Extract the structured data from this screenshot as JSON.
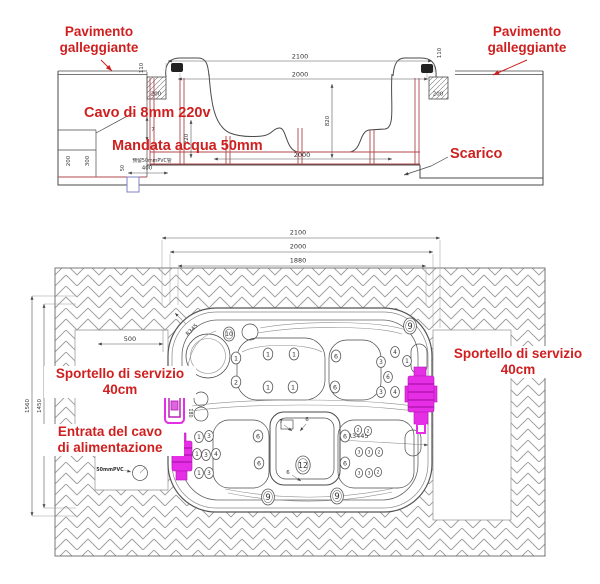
{
  "colors": {
    "red_label": "#cf1f1f",
    "magenta_highlight": "#e62ee6",
    "frame_red": "#b0494c",
    "line": "#4a4a4a",
    "conduit_blue": "#8080c8"
  },
  "section": {
    "labels": {
      "pavimento_left": "Pavimento\ngalleggiante",
      "pavimento_right": "Pavimento\ngalleggiante",
      "cavo": "Cavo di 8mm 220v",
      "mandata": "Mandata acqua 50mm",
      "scarico": "Scarico"
    },
    "dims": {
      "total_width": "2100",
      "rim_width": "2000",
      "depth": "820",
      "side_height": "220",
      "rim_h_left": "110",
      "rim_h_right": "110",
      "block_left": "200",
      "block_right": "200",
      "base_width": "2000",
      "wall_off1": "200",
      "wall_off2": "300",
      "pvc_offset": "400",
      "pvc_small": "50",
      "seven": "7",
      "pvc_note": "预留50mmPVC管"
    }
  },
  "plan": {
    "labels": {
      "sportello_left": "Sportello di servizio\n40cm",
      "sportello_right": "Sportello di servizio\n40cm",
      "entrata": "Entrata del cavo\ndi alimentazione",
      "pvc": "50mmPVC"
    },
    "dims": {
      "w1": "2100",
      "w2": "2000",
      "w3": "1880",
      "h1": "1560",
      "h2": "1450",
      "clear_left": "500",
      "r_corner": "R345",
      "r_body": "R3445",
      "door_note": "180"
    },
    "footwell": {
      "a": "7",
      "b": "6",
      "c": "6"
    },
    "jets": [
      {
        "n": "10",
        "x": 229,
        "y": 334,
        "r": 7,
        "double": true
      },
      {
        "n": "9",
        "x": 410,
        "y": 326,
        "r": 8,
        "double": true
      },
      {
        "n": "9",
        "x": 268,
        "y": 497,
        "r": 8,
        "double": true
      },
      {
        "n": "9",
        "x": 337,
        "y": 496,
        "r": 8,
        "double": true
      },
      {
        "n": "12",
        "x": 303,
        "y": 465,
        "r": 9,
        "double": true
      },
      {
        "n": "1",
        "x": 236,
        "y": 358,
        "r": 6
      },
      {
        "n": "2",
        "x": 236,
        "y": 382,
        "r": 6
      },
      {
        "n": "1",
        "x": 268,
        "y": 354,
        "r": 6
      },
      {
        "n": "1",
        "x": 294,
        "y": 354,
        "r": 6
      },
      {
        "n": "6",
        "x": 336,
        "y": 356,
        "r": 6
      },
      {
        "n": "1",
        "x": 268,
        "y": 387,
        "r": 6
      },
      {
        "n": "1",
        "x": 293,
        "y": 387,
        "r": 6
      },
      {
        "n": "6",
        "x": 335,
        "y": 387,
        "r": 6
      },
      {
        "n": "3",
        "x": 381,
        "y": 362,
        "r": 5.5
      },
      {
        "n": "4",
        "x": 395,
        "y": 352,
        "r": 5.5
      },
      {
        "n": "1",
        "x": 407,
        "y": 361,
        "r": 5.5
      },
      {
        "n": "6",
        "x": 388,
        "y": 377,
        "r": 5.5
      },
      {
        "n": "3",
        "x": 381,
        "y": 392,
        "r": 5.5
      },
      {
        "n": "4",
        "x": 395,
        "y": 392,
        "r": 5.5
      },
      {
        "n": "1",
        "x": 199,
        "y": 437,
        "r": 5.5
      },
      {
        "n": "3",
        "x": 209,
        "y": 436,
        "r": 5.5
      },
      {
        "n": "1",
        "x": 197,
        "y": 454,
        "r": 5.5
      },
      {
        "n": "3",
        "x": 206,
        "y": 455,
        "r": 5.5
      },
      {
        "n": "4",
        "x": 216,
        "y": 454,
        "r": 5.5
      },
      {
        "n": "1",
        "x": 199,
        "y": 473,
        "r": 5.5
      },
      {
        "n": "3",
        "x": 209,
        "y": 473,
        "r": 5.5
      },
      {
        "n": "6",
        "x": 258,
        "y": 436,
        "r": 6
      },
      {
        "n": "6",
        "x": 259,
        "y": 463,
        "r": 6
      },
      {
        "n": "6",
        "x": 345,
        "y": 436,
        "r": 6
      },
      {
        "n": "6",
        "x": 345,
        "y": 463,
        "r": 6
      },
      {
        "n": "2",
        "x": 358,
        "y": 430,
        "r": 4.5
      },
      {
        "n": "2",
        "x": 368,
        "y": 431,
        "r": 4.5
      },
      {
        "n": "3",
        "x": 359,
        "y": 452,
        "r": 4.5
      },
      {
        "n": "3",
        "x": 369,
        "y": 452,
        "r": 4.5
      },
      {
        "n": "2",
        "x": 379,
        "y": 452,
        "r": 4.5
      },
      {
        "n": "3",
        "x": 359,
        "y": 473,
        "r": 4.5
      },
      {
        "n": "3",
        "x": 369,
        "y": 473,
        "r": 4.5
      },
      {
        "n": "2",
        "x": 378,
        "y": 472,
        "r": 4.5
      }
    ]
  }
}
